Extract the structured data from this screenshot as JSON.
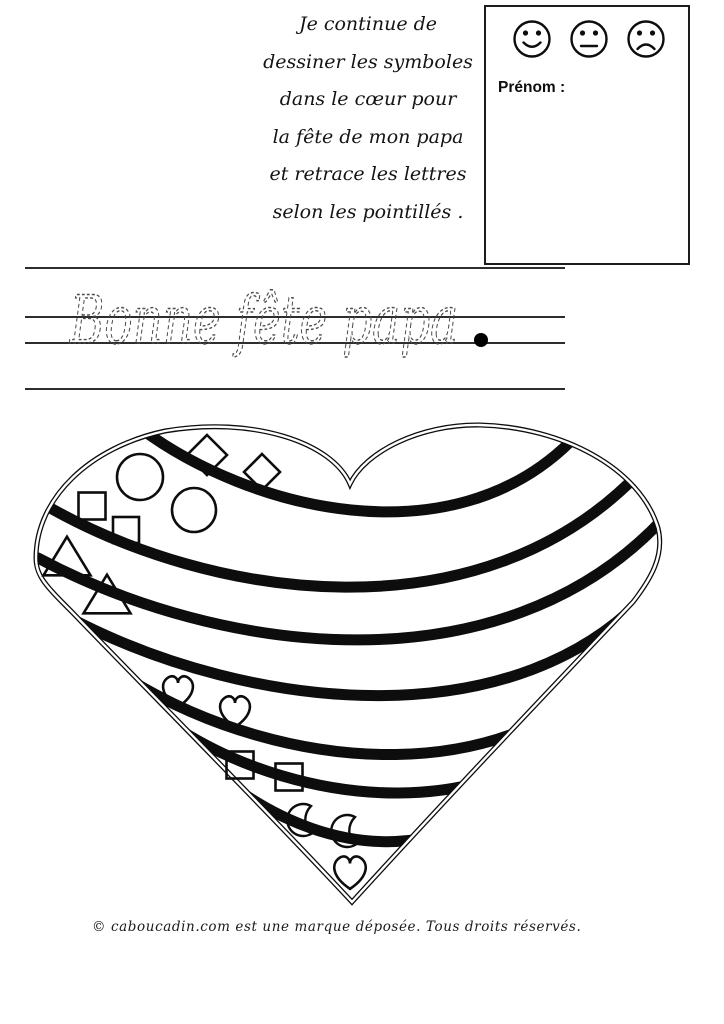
{
  "instructions": {
    "lines": [
      "Je continue de",
      "dessiner les symboles",
      "dans le cœur pour",
      "la fête de mon papa",
      "et retrace les lettres",
      "selon les pointillés ."
    ]
  },
  "name_box": {
    "label": "Prénom :",
    "smileys": [
      "happy",
      "neutral",
      "sad"
    ]
  },
  "tracing": {
    "text": "Bonne fête papa",
    "period": "."
  },
  "heart": {
    "stripe_count": 7,
    "shapes": [
      {
        "type": "diamond",
        "x": 207,
        "y": 455,
        "size": 40
      },
      {
        "type": "diamond",
        "x": 262,
        "y": 472,
        "size": 36
      },
      {
        "type": "circle",
        "x": 140,
        "y": 477,
        "size": 46
      },
      {
        "type": "circle",
        "x": 194,
        "y": 510,
        "size": 44
      },
      {
        "type": "square",
        "x": 92,
        "y": 506,
        "size": 27
      },
      {
        "type": "square",
        "x": 126,
        "y": 530,
        "size": 26
      },
      {
        "type": "triangle",
        "x": 67,
        "y": 556,
        "size": 47
      },
      {
        "type": "triangle",
        "x": 107,
        "y": 594,
        "size": 47
      },
      {
        "type": "heart",
        "x": 178,
        "y": 691,
        "size": 36
      },
      {
        "type": "heart",
        "x": 235,
        "y": 711,
        "size": 36
      },
      {
        "type": "square",
        "x": 240,
        "y": 765,
        "size": 27
      },
      {
        "type": "square",
        "x": 289,
        "y": 777,
        "size": 27
      },
      {
        "type": "moon",
        "x": 303,
        "y": 820,
        "size": 34
      },
      {
        "type": "moon",
        "x": 347,
        "y": 831,
        "size": 34
      },
      {
        "type": "heart",
        "x": 350,
        "y": 872,
        "size": 38
      }
    ]
  },
  "footer": {
    "text": "© caboucadin.com est une marque déposée.  Tous droits réservés."
  },
  "colors": {
    "ink": "#0d0d0d",
    "rule_line": "#2d2d2d",
    "trace": "#4a4a4a"
  }
}
